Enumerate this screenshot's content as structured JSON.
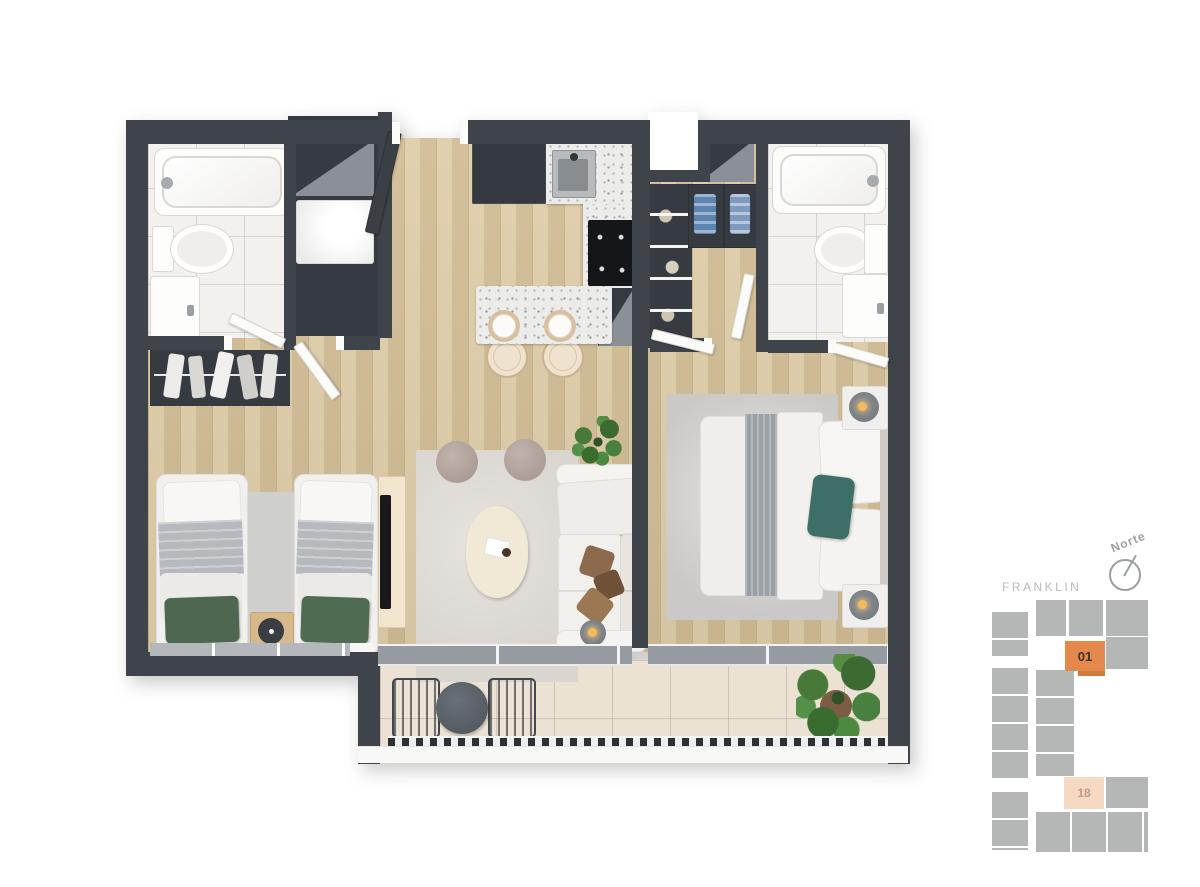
{
  "view": {
    "type": "apartment-floorplan-3d-top-view",
    "rooms_depicted": [
      "bathroom-1",
      "laundry-closet",
      "kitchen",
      "walk-in-closet",
      "bathroom-2",
      "bedroom-1",
      "bedroom-2",
      "living-room",
      "balcony"
    ]
  },
  "keyplan": {
    "street_label": "FRANKLIN",
    "north_label": "Norte",
    "compass_icon": "north-compass-icon",
    "units": [
      {
        "number": "01",
        "state": "highlighted"
      },
      {
        "number": "18",
        "state": "secondary"
      }
    ],
    "colors": {
      "unit_highlight": "#e5884c",
      "unit_highlight_text": "#39322e",
      "unit_secondary": "#f6d9c3",
      "unit_secondary_text": "#c59b80",
      "building": "#b5b6b6",
      "label_gray": "#b9b9b9"
    }
  },
  "palette": {
    "wall": "#3f444b",
    "wood_floor": "#dcc8a0",
    "bath_tile": "#f3f1ee",
    "balcony_tile": "#ebe2d4",
    "terrazzo_counter": "#ececea",
    "accent_teal_pillow": "#3e6f66",
    "accent_green_pillow": "#51684f",
    "plant_green": "#47783a"
  }
}
